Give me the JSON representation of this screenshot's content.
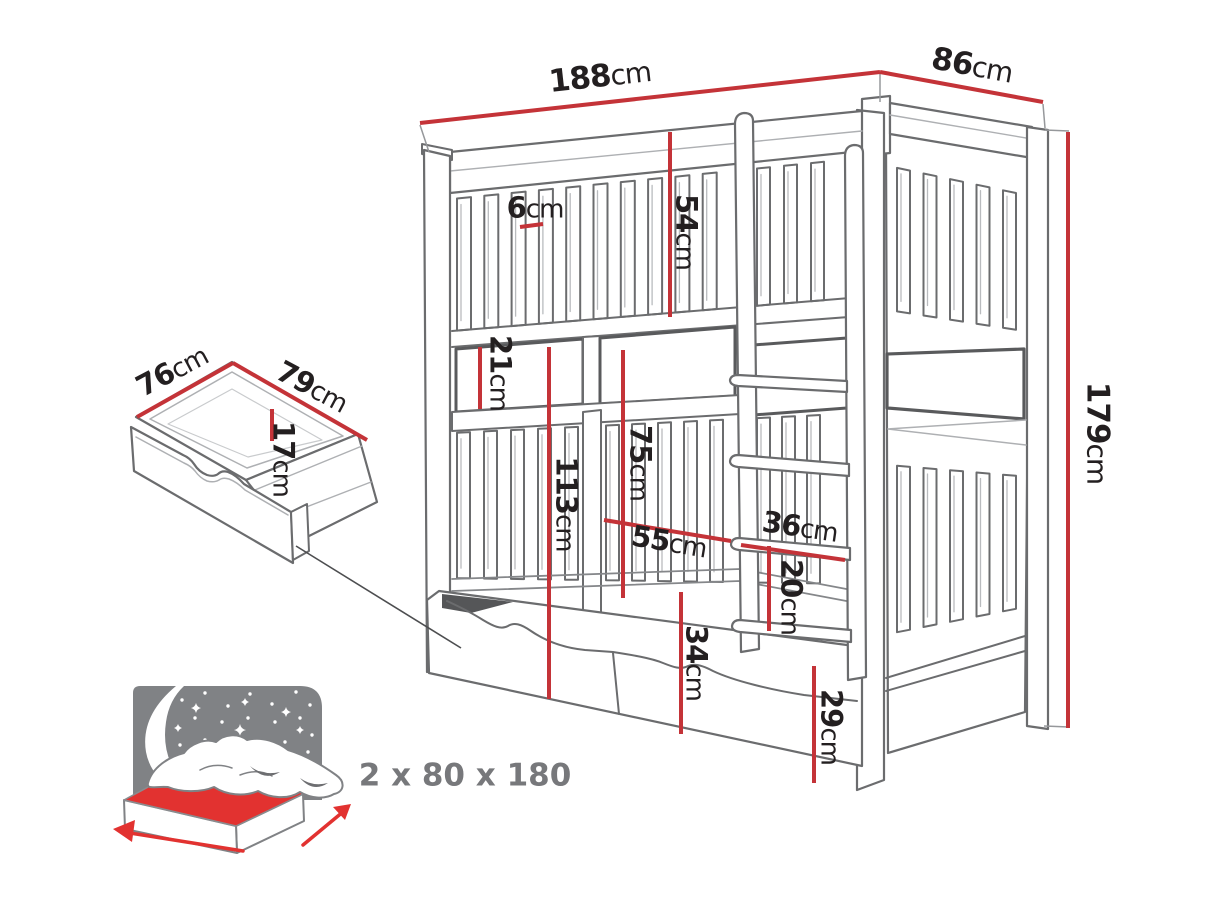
{
  "figure": {
    "type": "furniture-dimension-diagram",
    "subject": "bunk bed with storage drawers"
  },
  "colors": {
    "dimension_red": "#c43338",
    "mattress_red": "#e23230",
    "line_gray": "#6b6c6e",
    "icon_gray": "#808285",
    "text_black": "#231f20",
    "text_gray": "#77787b"
  },
  "icons": {
    "mattress_icon": "double-bed-with-starry-night-headboard",
    "width_arrow_icon": "red-arrow-left",
    "length_arrow_icon": "red-arrow-up-right",
    "drawer_icon": "open-storage-drawer",
    "bed_icon": "bunk-bed-line-drawing"
  },
  "bed": {
    "dimensions": {
      "total_width": {
        "value": "188",
        "unit": "cm"
      },
      "total_depth": {
        "value": "86",
        "unit": "cm"
      },
      "total_height": {
        "value": "179",
        "unit": "cm"
      },
      "slat_gap": {
        "value": "6",
        "unit": "cm"
      },
      "upper_guard_height": {
        "value": "54",
        "unit": "cm"
      },
      "bunk_gap": {
        "value": "21",
        "unit": "cm"
      },
      "under_upper_height": {
        "value": "113",
        "unit": "cm"
      },
      "lower_guard_height": {
        "value": "75",
        "unit": "cm"
      },
      "entry_width": {
        "value": "55",
        "unit": "cm"
      },
      "ladder_width": {
        "value": "36",
        "unit": "cm"
      },
      "rung_spacing": {
        "value": "20",
        "unit": "cm"
      },
      "drawer_front_height": {
        "value": "34",
        "unit": "cm"
      },
      "base_height": {
        "value": "29",
        "unit": "cm"
      }
    }
  },
  "drawer": {
    "dimensions": {
      "depth": {
        "value": "76",
        "unit": "cm"
      },
      "width": {
        "value": "79",
        "unit": "cm"
      },
      "height": {
        "value": "17",
        "unit": "cm"
      }
    }
  },
  "mattress": {
    "size_label": "2 x 80 x 180"
  }
}
